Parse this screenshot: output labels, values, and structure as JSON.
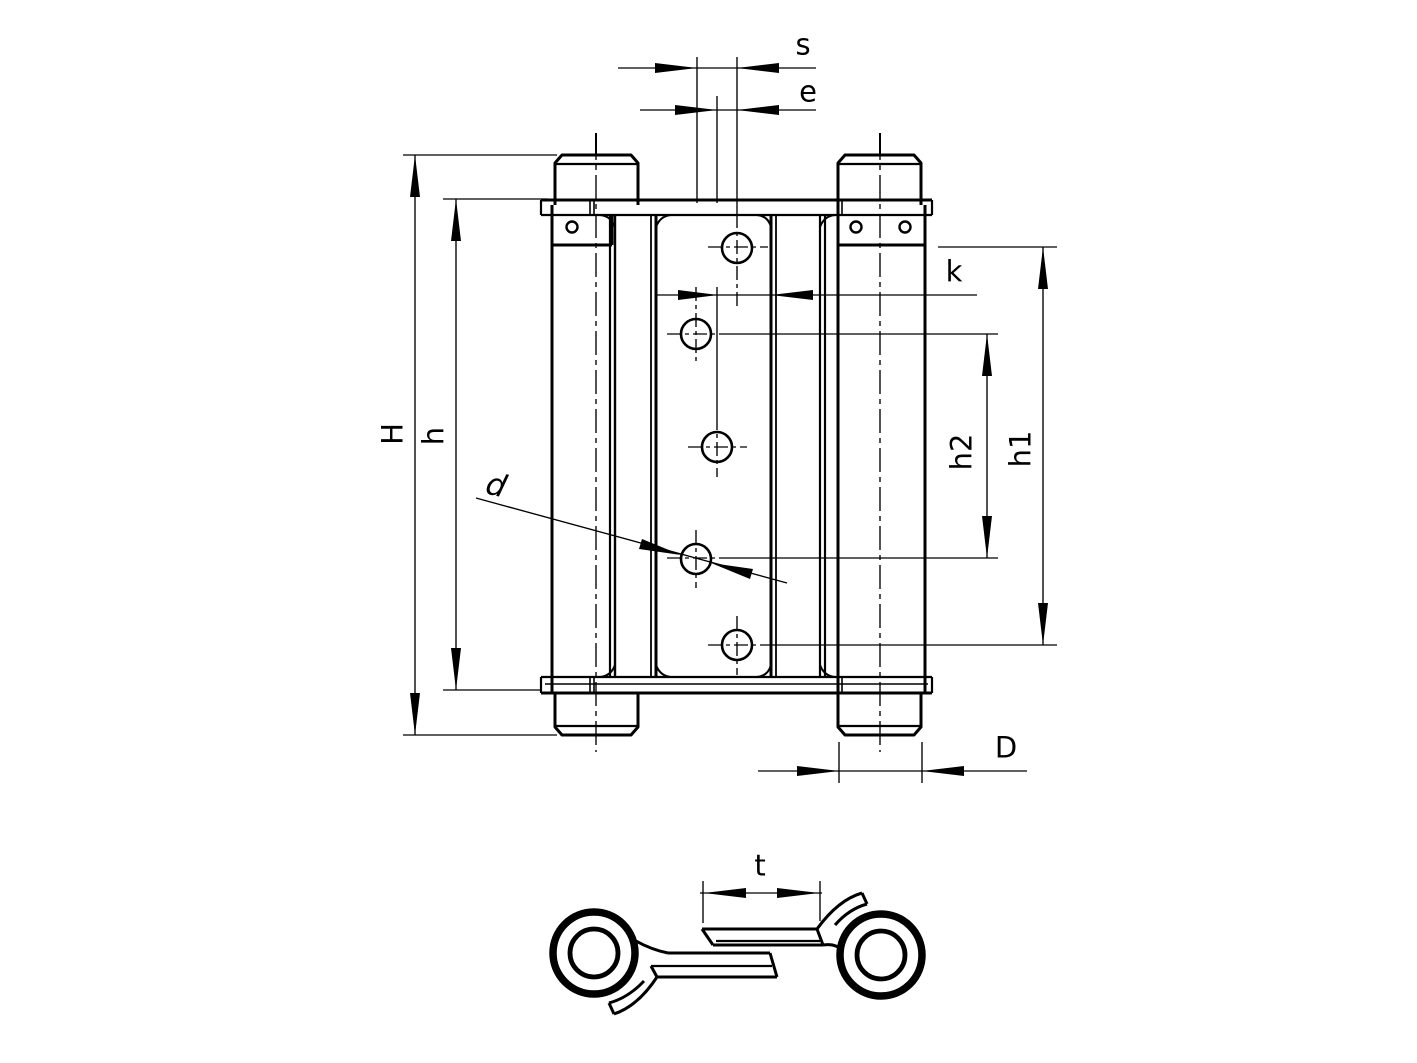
{
  "page": {
    "title": "Double-action spring hinge technical drawing",
    "background_color": "#ffffff",
    "line_color": "#000000"
  },
  "views": {
    "front_elevation": {
      "description": "hinge front view with two spring barrels, caps, center leaf with five countersunk screw holes and three small pin holes",
      "countersunk_hole_count": 5,
      "small_hole_count": 3
    },
    "cross_section": {
      "description": "horizontal section showing two coiled barrels and overlapping S-shaped leaves"
    }
  },
  "dimension_labels": {
    "s": "s",
    "e": "e",
    "k": "k",
    "H": "H",
    "h": "h",
    "h2": "h2",
    "h1": "h1",
    "d": "d",
    "D": "D",
    "t": "t"
  }
}
